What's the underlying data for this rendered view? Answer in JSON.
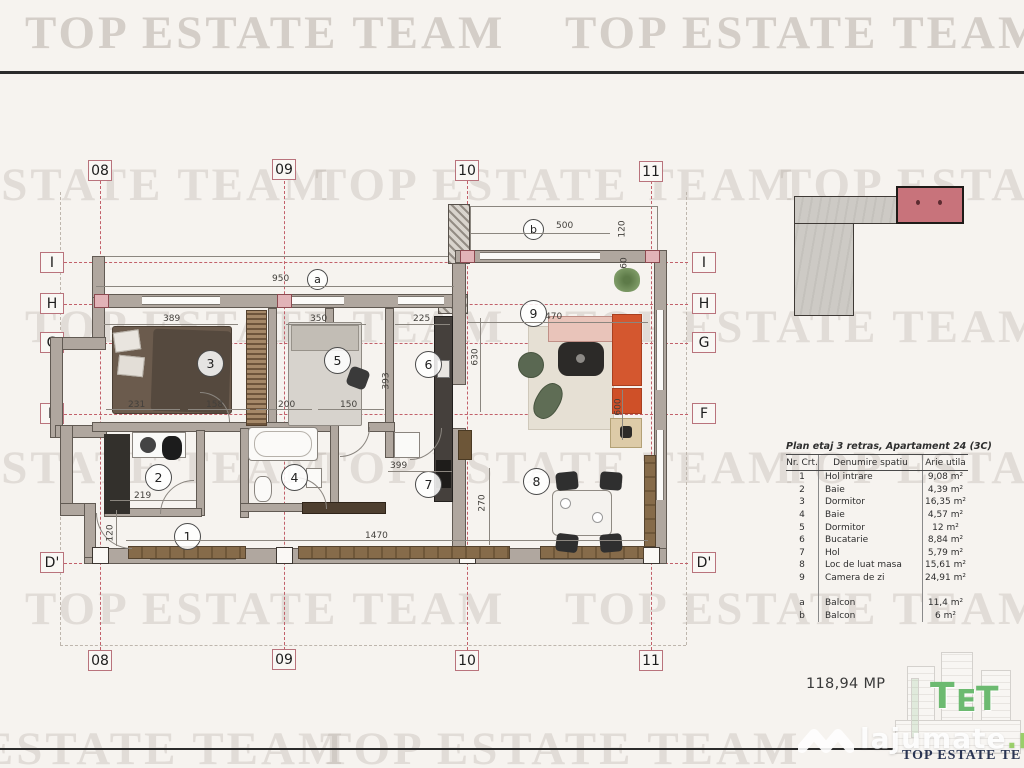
{
  "watermark": {
    "text": "TOP ESTATE TEAM"
  },
  "site_watermark": {
    "name": "lajumate",
    "tld": ".ro"
  },
  "total_area": "118,94 MP",
  "logo": {
    "letters": [
      "T",
      "E",
      "T"
    ],
    "caption": "TOP ESTATE TE"
  },
  "colors": {
    "grid_red": "#c2606a",
    "wall_gray": "#b0a79f",
    "sofa_orange": "#d4572f",
    "keyplan_highlight": "#c8737b",
    "logo_green": "#6cba70",
    "caption_navy": "#2a3553"
  },
  "plan": {
    "grid_cols": [
      "08",
      "09",
      "10",
      "11"
    ],
    "grid_rows": [
      "I",
      "H",
      "G",
      "F",
      "D'"
    ],
    "room_labels": [
      "1",
      "2",
      "3",
      "4",
      "5",
      "6",
      "7",
      "8",
      "9"
    ],
    "balcony_labels": {
      "a": "a",
      "b": "b"
    },
    "dims": {
      "d950": "950",
      "d500": "500",
      "d120_balcony": "120",
      "d60": "60",
      "d389": "389",
      "d350": "350",
      "d225": "225",
      "d470": "470",
      "d231": "231",
      "d158": "158",
      "d200": "200",
      "d150": "150",
      "d399": "399",
      "d219": "219",
      "d120_hall": "120",
      "d1470": "1470",
      "d270": "270",
      "d630": "630",
      "d393": "393",
      "d600": "600"
    }
  },
  "table": {
    "title": "Plan etaj 3 retras, Apartament 24 (3C)",
    "headers": [
      "Nr. Crt.",
      "Denumire spatiu",
      "Arie utila"
    ],
    "rows": [
      [
        "1",
        "Hol intrare",
        "9,08 m²"
      ],
      [
        "2",
        "Baie",
        "4,39 m²"
      ],
      [
        "3",
        "Dormitor",
        "16,35 m²"
      ],
      [
        "4",
        "Baie",
        "4,57 m²"
      ],
      [
        "5",
        "Dormitor",
        "12 m²"
      ],
      [
        "6",
        "Bucatarie",
        "8,84 m²"
      ],
      [
        "7",
        "Hol",
        "5,79 m²"
      ],
      [
        "8",
        "Loc de luat masa",
        "15,61 m²"
      ],
      [
        "9",
        "Camera de zi",
        "24,91 m²"
      ],
      [
        "a",
        "Balcon",
        "11,4 m²"
      ],
      [
        "b",
        "Balcon",
        "6 m²"
      ]
    ]
  }
}
